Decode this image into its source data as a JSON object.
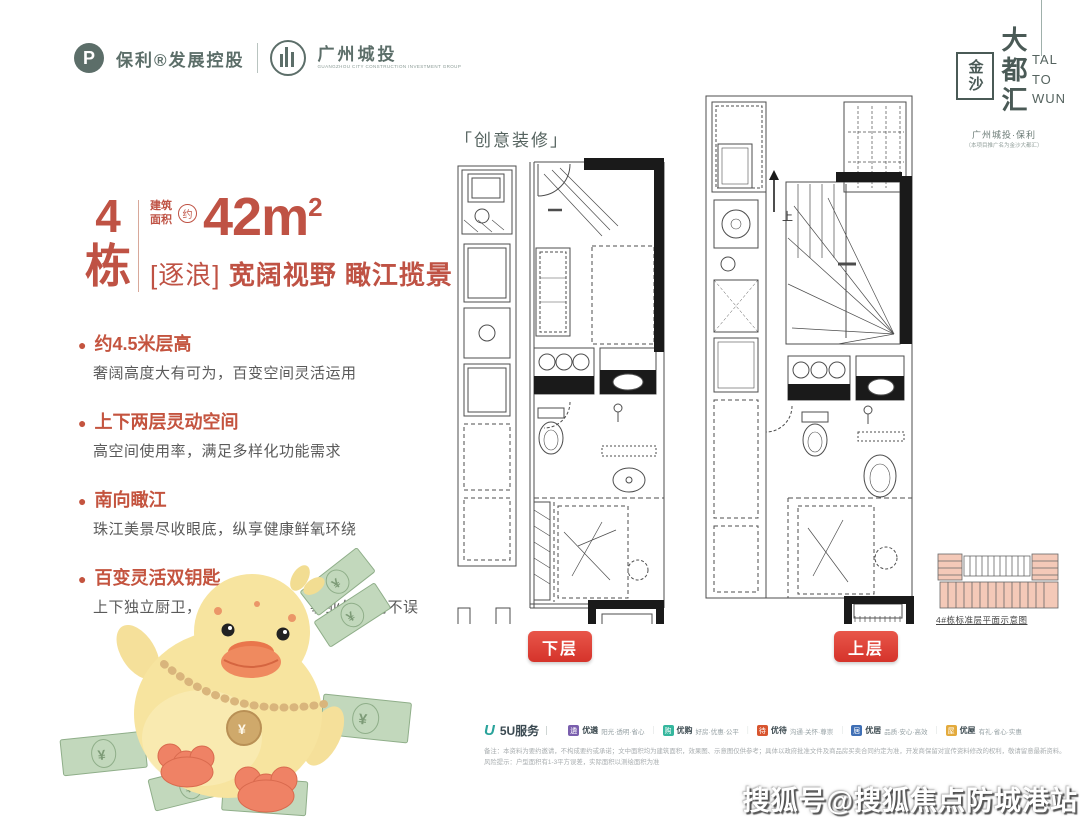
{
  "colors": {
    "accent_red": "#bf5244",
    "feature_red": "#c4543f",
    "button_red": "#d5332b",
    "brand_teal": "#5c6e69",
    "plan_line": "#4d4d4d",
    "keyplan_pink": "#f4c9b8",
    "duck_body": "#f7e49f",
    "duck_accent": "#ef8265",
    "money_green": "#c2d8bc",
    "watermark_white": "#ffffff"
  },
  "header": {
    "brand_left": {
      "mark": "P",
      "text": "保利®发展控股"
    },
    "brand_right": {
      "text": "广州城投",
      "sub": "GUANGZHOU CITY CONSTRUCTION INVESTMENT GROUP"
    }
  },
  "corner_logo": {
    "seal": "金沙",
    "big": "大都汇",
    "latin1": "TAL",
    "latin2": "TO",
    "latin3": "WUN",
    "sub1": "广州城投·保利",
    "sub2": "（本项目推广名为金沙大都汇）"
  },
  "headline": {
    "building_no": "4",
    "building_unit": "栋",
    "area_label_1": "建筑",
    "area_label_2": "面积",
    "approx": "约",
    "area_value": "42m",
    "area_sup": "2",
    "tagline_bracketed": "[逐浪]",
    "tagline_rest": "宽阔视野 瞰江揽景"
  },
  "features": [
    {
      "title": "约4.5米层高",
      "desc": "奢阔高度大有可为，百变空间灵活运用"
    },
    {
      "title": "上下两层灵动空间",
      "desc": "高空间使用率，满足多样化功能需求"
    },
    {
      "title": "南向瞰江",
      "desc": "珠江美景尽收眼底，纵享健康鲜氧环绕"
    },
    {
      "title": "百变灵活双钥匙",
      "desc": "上下独立厨卫，多元投资模式，事业生活两不误"
    }
  ],
  "plans": {
    "deco_label": "「创意装修」",
    "lower_label": "下层",
    "upper_label": "上层",
    "up_label": "上",
    "keyplan_caption": "4#栋标准层平面示意图"
  },
  "services": {
    "logo": "5U服务",
    "items": [
      {
        "label": "优遴",
        "desc": "阳光·透明·省心",
        "color": "#7a5fae",
        "icon_char": "遴"
      },
      {
        "label": "优购",
        "desc": "好房·优惠·公平",
        "color": "#35b79e",
        "icon_char": "购"
      },
      {
        "label": "优待",
        "desc": "沟通·关怀·尊崇",
        "color": "#d8552f",
        "icon_char": "待"
      },
      {
        "label": "优居",
        "desc": "品质·安心·高效",
        "color": "#3f6fb5",
        "icon_char": "居"
      },
      {
        "label": "优屋",
        "desc": "有礼·省心·实惠",
        "color": "#e3aa3c",
        "icon_char": "屋"
      }
    ]
  },
  "disclaimer": {
    "line1": "备注：本资料为要约邀请，不构成要约或承诺；文中面积均为建筑面积，效果图、示意图仅供参考；具体以政府批准文件及商品房买卖合同约定为准，开发商保留对宣传资料修改的权利，敬请留意最新资料。",
    "line2": "风险提示：户型面积有1-3平方误差，实际面积以测绘面积为准"
  },
  "watermark": {
    "text": "搜狐号@搜狐焦点防城港站"
  }
}
